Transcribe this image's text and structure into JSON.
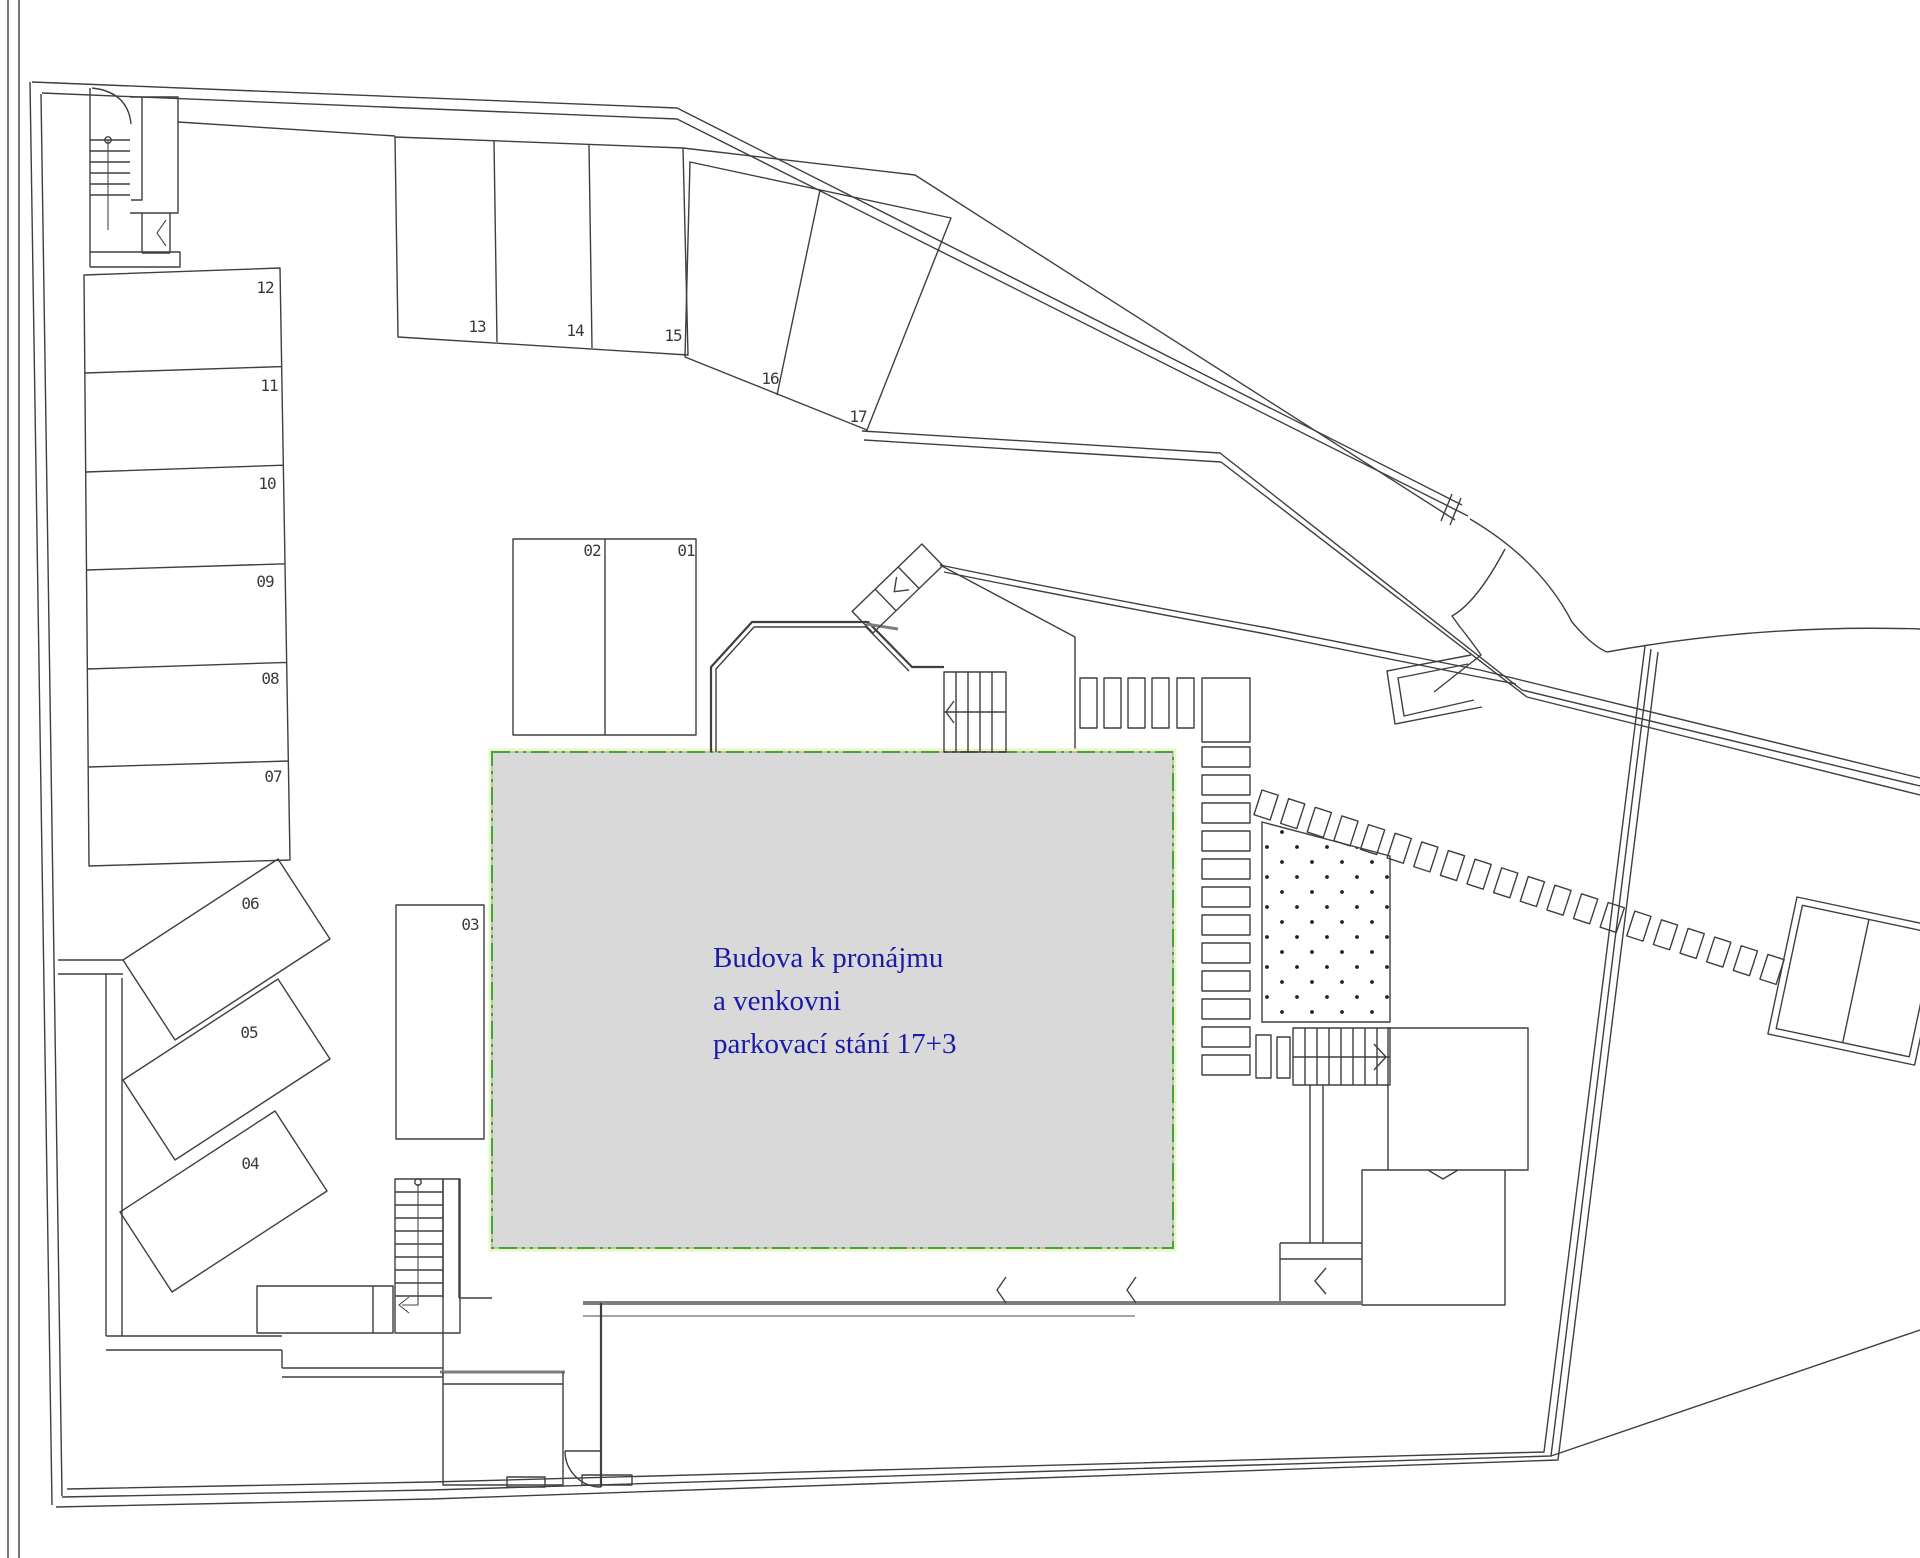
{
  "annotation": {
    "line1": "Budova k pronájmu",
    "line2": "a venkovni",
    "line3": "parkovací stání 17+3",
    "text_color": "#1b1ba8"
  },
  "spaces": {
    "s01": "01",
    "s02": "02",
    "s03": "03",
    "s04": "04",
    "s05": "05",
    "s06": "06",
    "s07": "07",
    "s08": "08",
    "s09": "09",
    "s10": "10",
    "s11": "11",
    "s12": "12",
    "s13": "13",
    "s14": "14",
    "s15": "15",
    "s16": "16",
    "s17": "17"
  },
  "colors": {
    "drawing_line": "#3f3f3f",
    "thick_wall": "#7d7d7d",
    "building_fill": "#d9d9d9",
    "building_border_green": "#3ea63a",
    "building_border_glow": "#eef3c3",
    "label_color": "#3a3a3a",
    "background": "#ffffff"
  }
}
